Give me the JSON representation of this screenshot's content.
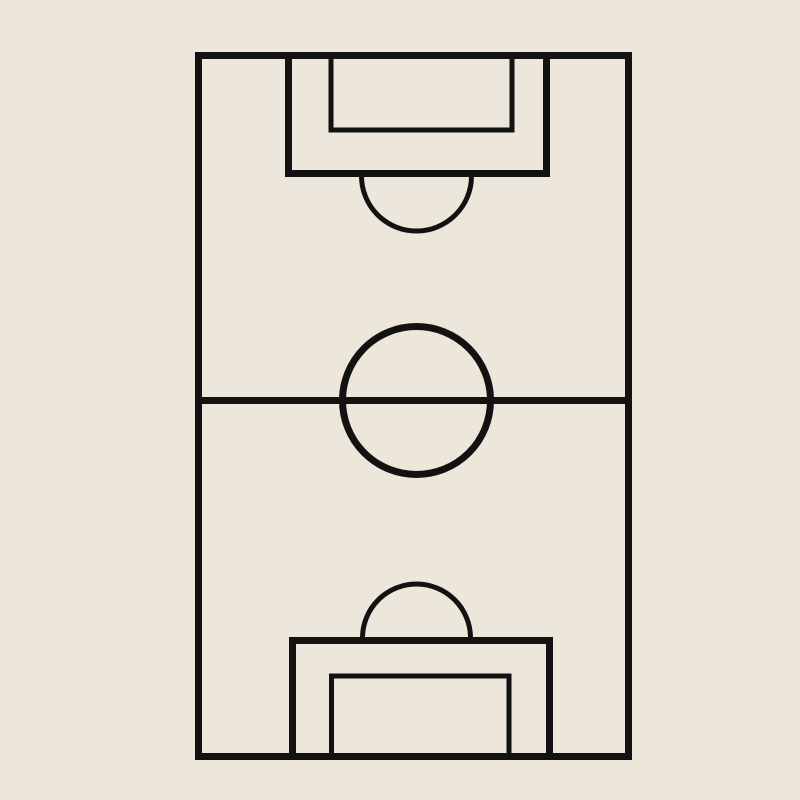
{
  "diagram": {
    "kind": "football-pitch-diagram",
    "background_color": "#ECE7DA",
    "line_color": "#121212",
    "canvas": {
      "width": 800,
      "height": 800
    },
    "elements": [
      {
        "name": "pitch-outline",
        "type": "rect",
        "x": 198.5,
        "y": 55.5,
        "width": 430,
        "height": 701,
        "stroke_width": 7
      },
      {
        "name": "halfway-line",
        "type": "line",
        "x1": 195,
        "y1": 400.5,
        "x2": 632,
        "y2": 400.5,
        "stroke_width": 7
      },
      {
        "name": "center-circle",
        "type": "circle",
        "cx": 416.5,
        "cy": 400.5,
        "r": 74,
        "stroke_width": 7
      },
      {
        "name": "top-penalty-area",
        "type": "path",
        "d": "M 288.5 52 L 288.5 173.5 L 546.5 173.5 L 546.5 52",
        "stroke_width": 7
      },
      {
        "name": "top-goal-area",
        "type": "path",
        "d": "M 331 52 L 331 130 L 512 130 L 512 52",
        "stroke_width": 5
      },
      {
        "name": "top-penalty-arc",
        "type": "path",
        "d": "M 361.5 176 A 55 55 0 0 0 471.5 176",
        "stroke_width": 5
      },
      {
        "name": "bottom-penalty-area",
        "type": "path",
        "d": "M 292.5 757 L 292.5 640.5 L 549.5 640.5 L 549.5 757",
        "stroke_width": 7
      },
      {
        "name": "bottom-goal-area",
        "type": "path",
        "d": "M 331.5 757 L 331.5 676 L 509 676 L 509 757",
        "stroke_width": 5
      },
      {
        "name": "bottom-penalty-arc",
        "type": "path",
        "d": "M 362.5 638 A 54 54 0 0 1 470.5 638",
        "stroke_width": 5
      }
    ]
  }
}
